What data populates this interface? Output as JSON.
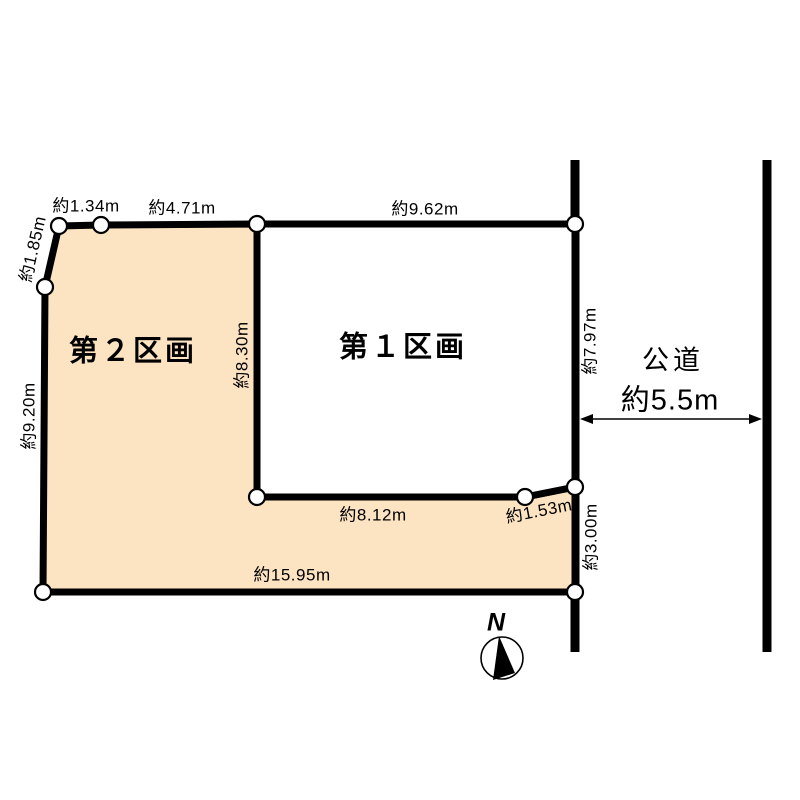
{
  "diagram": {
    "parcel1_label": "第１区画",
    "parcel2_label": "第２区画",
    "road_name": "公道",
    "road_width_label": "約5.5m",
    "compass_north_label": "N"
  },
  "dimensions": [
    {
      "edge": "top-left-short",
      "text": "約1.34m"
    },
    {
      "edge": "top-parcel2",
      "text": "約4.71m"
    },
    {
      "edge": "top-parcel1",
      "text": "約9.62m"
    },
    {
      "edge": "northwest-slant",
      "text": "約1.85m"
    },
    {
      "edge": "west-side",
      "text": "約9.20m"
    },
    {
      "edge": "inner-border",
      "text": "約8.30m"
    },
    {
      "edge": "east-road-frontage",
      "text": "約7.97m"
    },
    {
      "edge": "notch-bottom",
      "text": "約8.12m"
    },
    {
      "edge": "southeast-slant",
      "text": "約1.53m"
    },
    {
      "edge": "east-parcel2",
      "text": "約3.00m"
    },
    {
      "edge": "south-side",
      "text": "約15.95m"
    }
  ],
  "colors": {
    "outline": "#000000",
    "parcel1_fill": "#ffffff",
    "parcel2_fill": "#fce3c2",
    "marker_fill": "#ffffff",
    "background": "#ffffff"
  }
}
